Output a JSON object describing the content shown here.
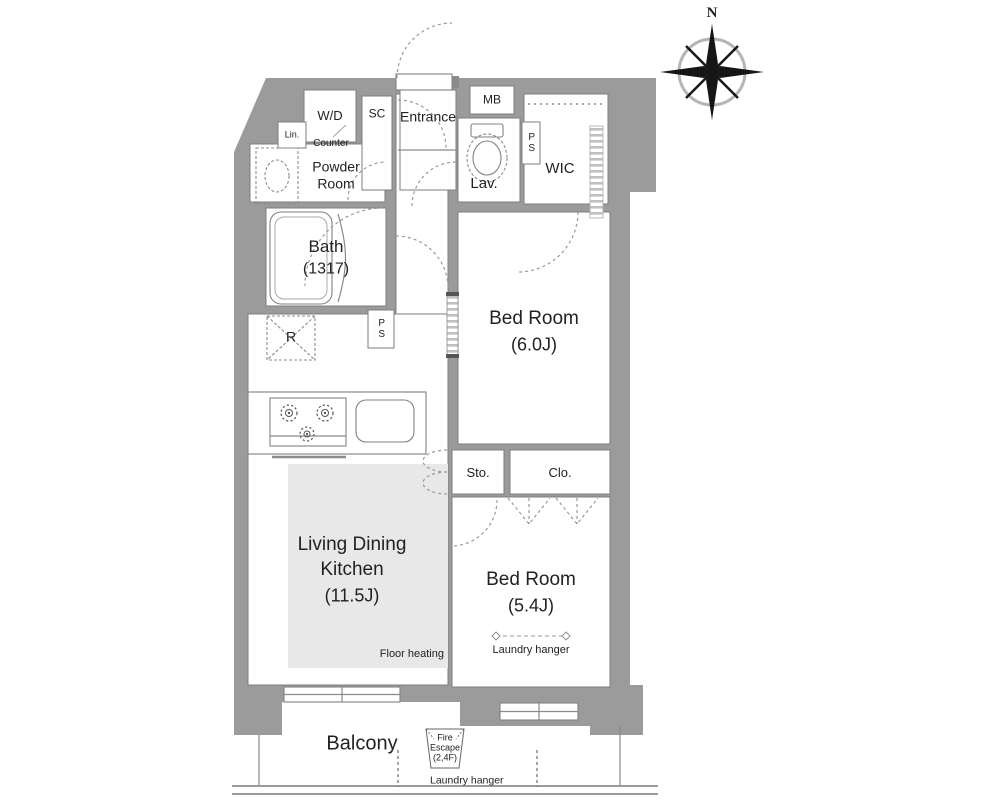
{
  "colors": {
    "wall": "#9b9b9b",
    "room": "#ffffff",
    "floor_heating": "#e8e8e8",
    "line": "#8a8a8a",
    "text": "#222222"
  },
  "compass": {
    "north_label": "N"
  },
  "labels": {
    "wd": "W/D",
    "sc": "SC",
    "entrance": "Entrance",
    "mb": "MB",
    "lin": "Lin.",
    "counter": "Counter",
    "powder_room_line1": "Powder",
    "powder_room_line2": "Room",
    "lav": "Lav.",
    "ps_upper": "PS",
    "ps_lower": "PS",
    "wic": "WIC",
    "bath_name": "Bath",
    "bath_size": "(1317)",
    "refrigerator": "R",
    "bedroom1_name": "Bed Room",
    "bedroom1_size": "(6.0J)",
    "sto": "Sto.",
    "clo": "Clo.",
    "ldk_line1": "Living Dining",
    "ldk_line2": "Kitchen",
    "ldk_size": "(11.5J)",
    "floor_heating": "Floor heating",
    "bedroom2_name": "Bed Room",
    "bedroom2_size": "(5.4J)",
    "bedroom2_laundry": "Laundry hanger",
    "balcony": "Balcony",
    "balcony_laundry": "Laundry hanger",
    "fire_escape_line1": "Fire",
    "fire_escape_line2": "Escape",
    "fire_escape_line3": "(2,4F)"
  }
}
